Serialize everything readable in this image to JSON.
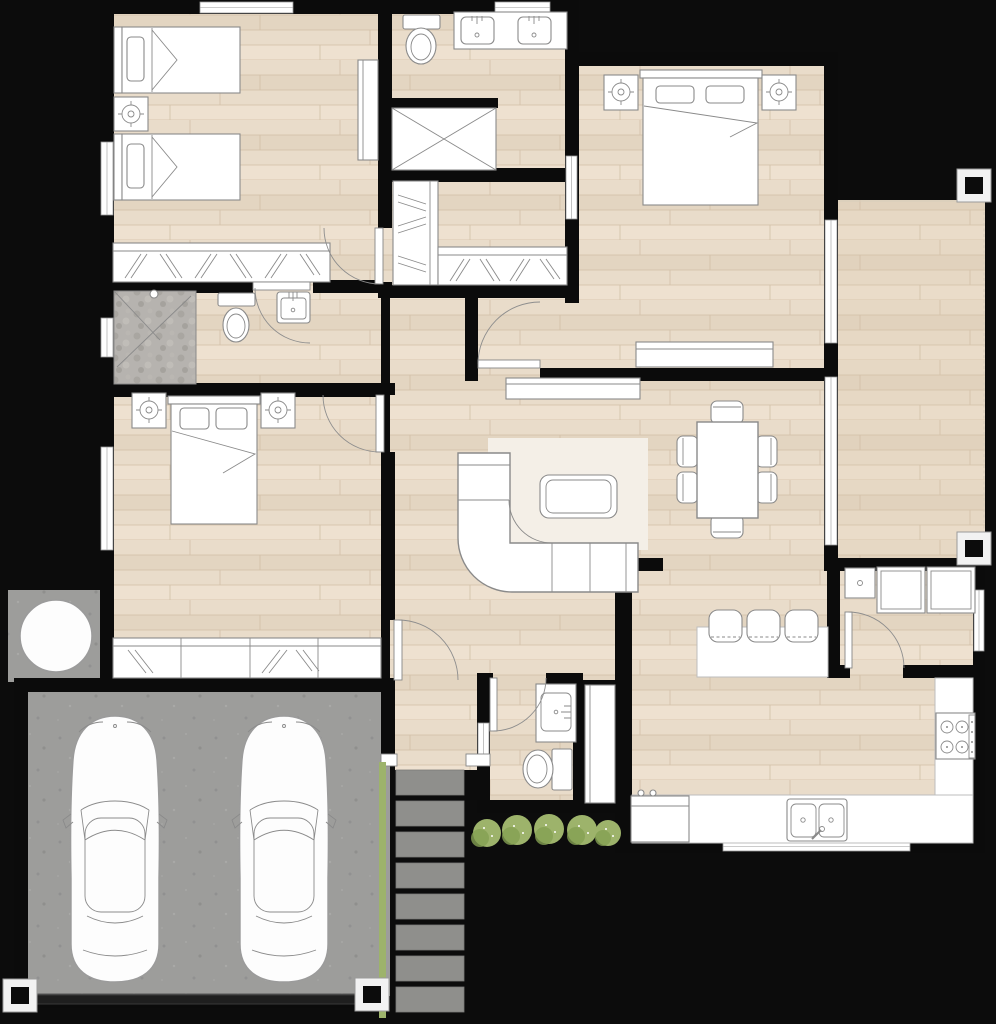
{
  "scene": {
    "type": "architectural-floor-plan",
    "view": "top-down",
    "canvas_width": 996,
    "canvas_height": 1024,
    "visible_text": "none"
  },
  "colors": {
    "bg": "#0c0c0c",
    "wall": "#0b0b0b",
    "floor": "#e9dcca",
    "deck-tint": "#d9c6ad",
    "concrete": "#9d9d9b",
    "paver": "#8f8f8c",
    "pebble": "#b6b3af",
    "fixture-fill": "#ffffff",
    "fixture-stroke": "#8a8a8a",
    "counter-stroke": "#bdbdbd",
    "rug": "#f4efe7",
    "glass": "#ffffff",
    "hedge": "#9db36b",
    "hedge-dark": "#85a053"
  },
  "rooms": [
    {
      "name": "kids-bedroom",
      "furniture": [
        "twin-bed",
        "twin-bed",
        "nightstand-with-lamp",
        "wardrobe",
        "closet-with-hanging-rail",
        "window"
      ]
    },
    {
      "name": "hall-bathroom",
      "furniture": [
        "toilet",
        "double-sink-vanity",
        "shower-tub",
        "window"
      ]
    },
    {
      "name": "walk-in-closet",
      "furniture": [
        "l-shaped-hanging-rail"
      ]
    },
    {
      "name": "master-bedroom",
      "furniture": [
        "double-bed",
        "nightstand-with-lamp",
        "nightstand-with-lamp",
        "dresser",
        "window-to-deck"
      ]
    },
    {
      "name": "ensuite-bathroom",
      "furniture": [
        "pebble-floor-shower",
        "toilet",
        "wall-sink",
        "window"
      ]
    },
    {
      "name": "bedroom-2",
      "furniture": [
        "double-bed",
        "nightstand-with-lamp",
        "nightstand-with-lamp",
        "sliding-door-closet",
        "window"
      ]
    },
    {
      "name": "living-room",
      "furniture": [
        "corner-sofa",
        "coffee-table",
        "rug",
        "tv-console"
      ]
    },
    {
      "name": "dining-area",
      "furniture": [
        "dining-table",
        "six-chairs"
      ]
    },
    {
      "name": "kitchen",
      "furniture": [
        "island-with-stools",
        "l-shaped-counter",
        "cooktop",
        "double-sink",
        "dishwasher",
        "window"
      ]
    },
    {
      "name": "pantry-laundry",
      "furniture": [
        "cabinet",
        "washer",
        "dryer",
        "window"
      ]
    },
    {
      "name": "powder-room",
      "furniture": [
        "vanity-sink",
        "toilet",
        "pocket-door-panel"
      ]
    },
    {
      "name": "entry-hall",
      "furniture": [
        "front-door-opening",
        "side-window"
      ]
    },
    {
      "name": "garage",
      "furniture": [
        "car",
        "car",
        "garage-door",
        "column",
        "column"
      ]
    },
    {
      "name": "deck",
      "furniture": [
        "column",
        "column"
      ]
    },
    {
      "name": "outdoor",
      "furniture": [
        "entry-steps",
        "hedge-strip",
        "bushes",
        "round-pad"
      ]
    }
  ],
  "counts": {
    "bedrooms": 3,
    "bathrooms": 3,
    "cars": 2,
    "entry-steps": 8,
    "bar-stools": 3,
    "dining-chairs": 6,
    "columns": 4,
    "bushes": 5,
    "swing-doors": 7
  }
}
